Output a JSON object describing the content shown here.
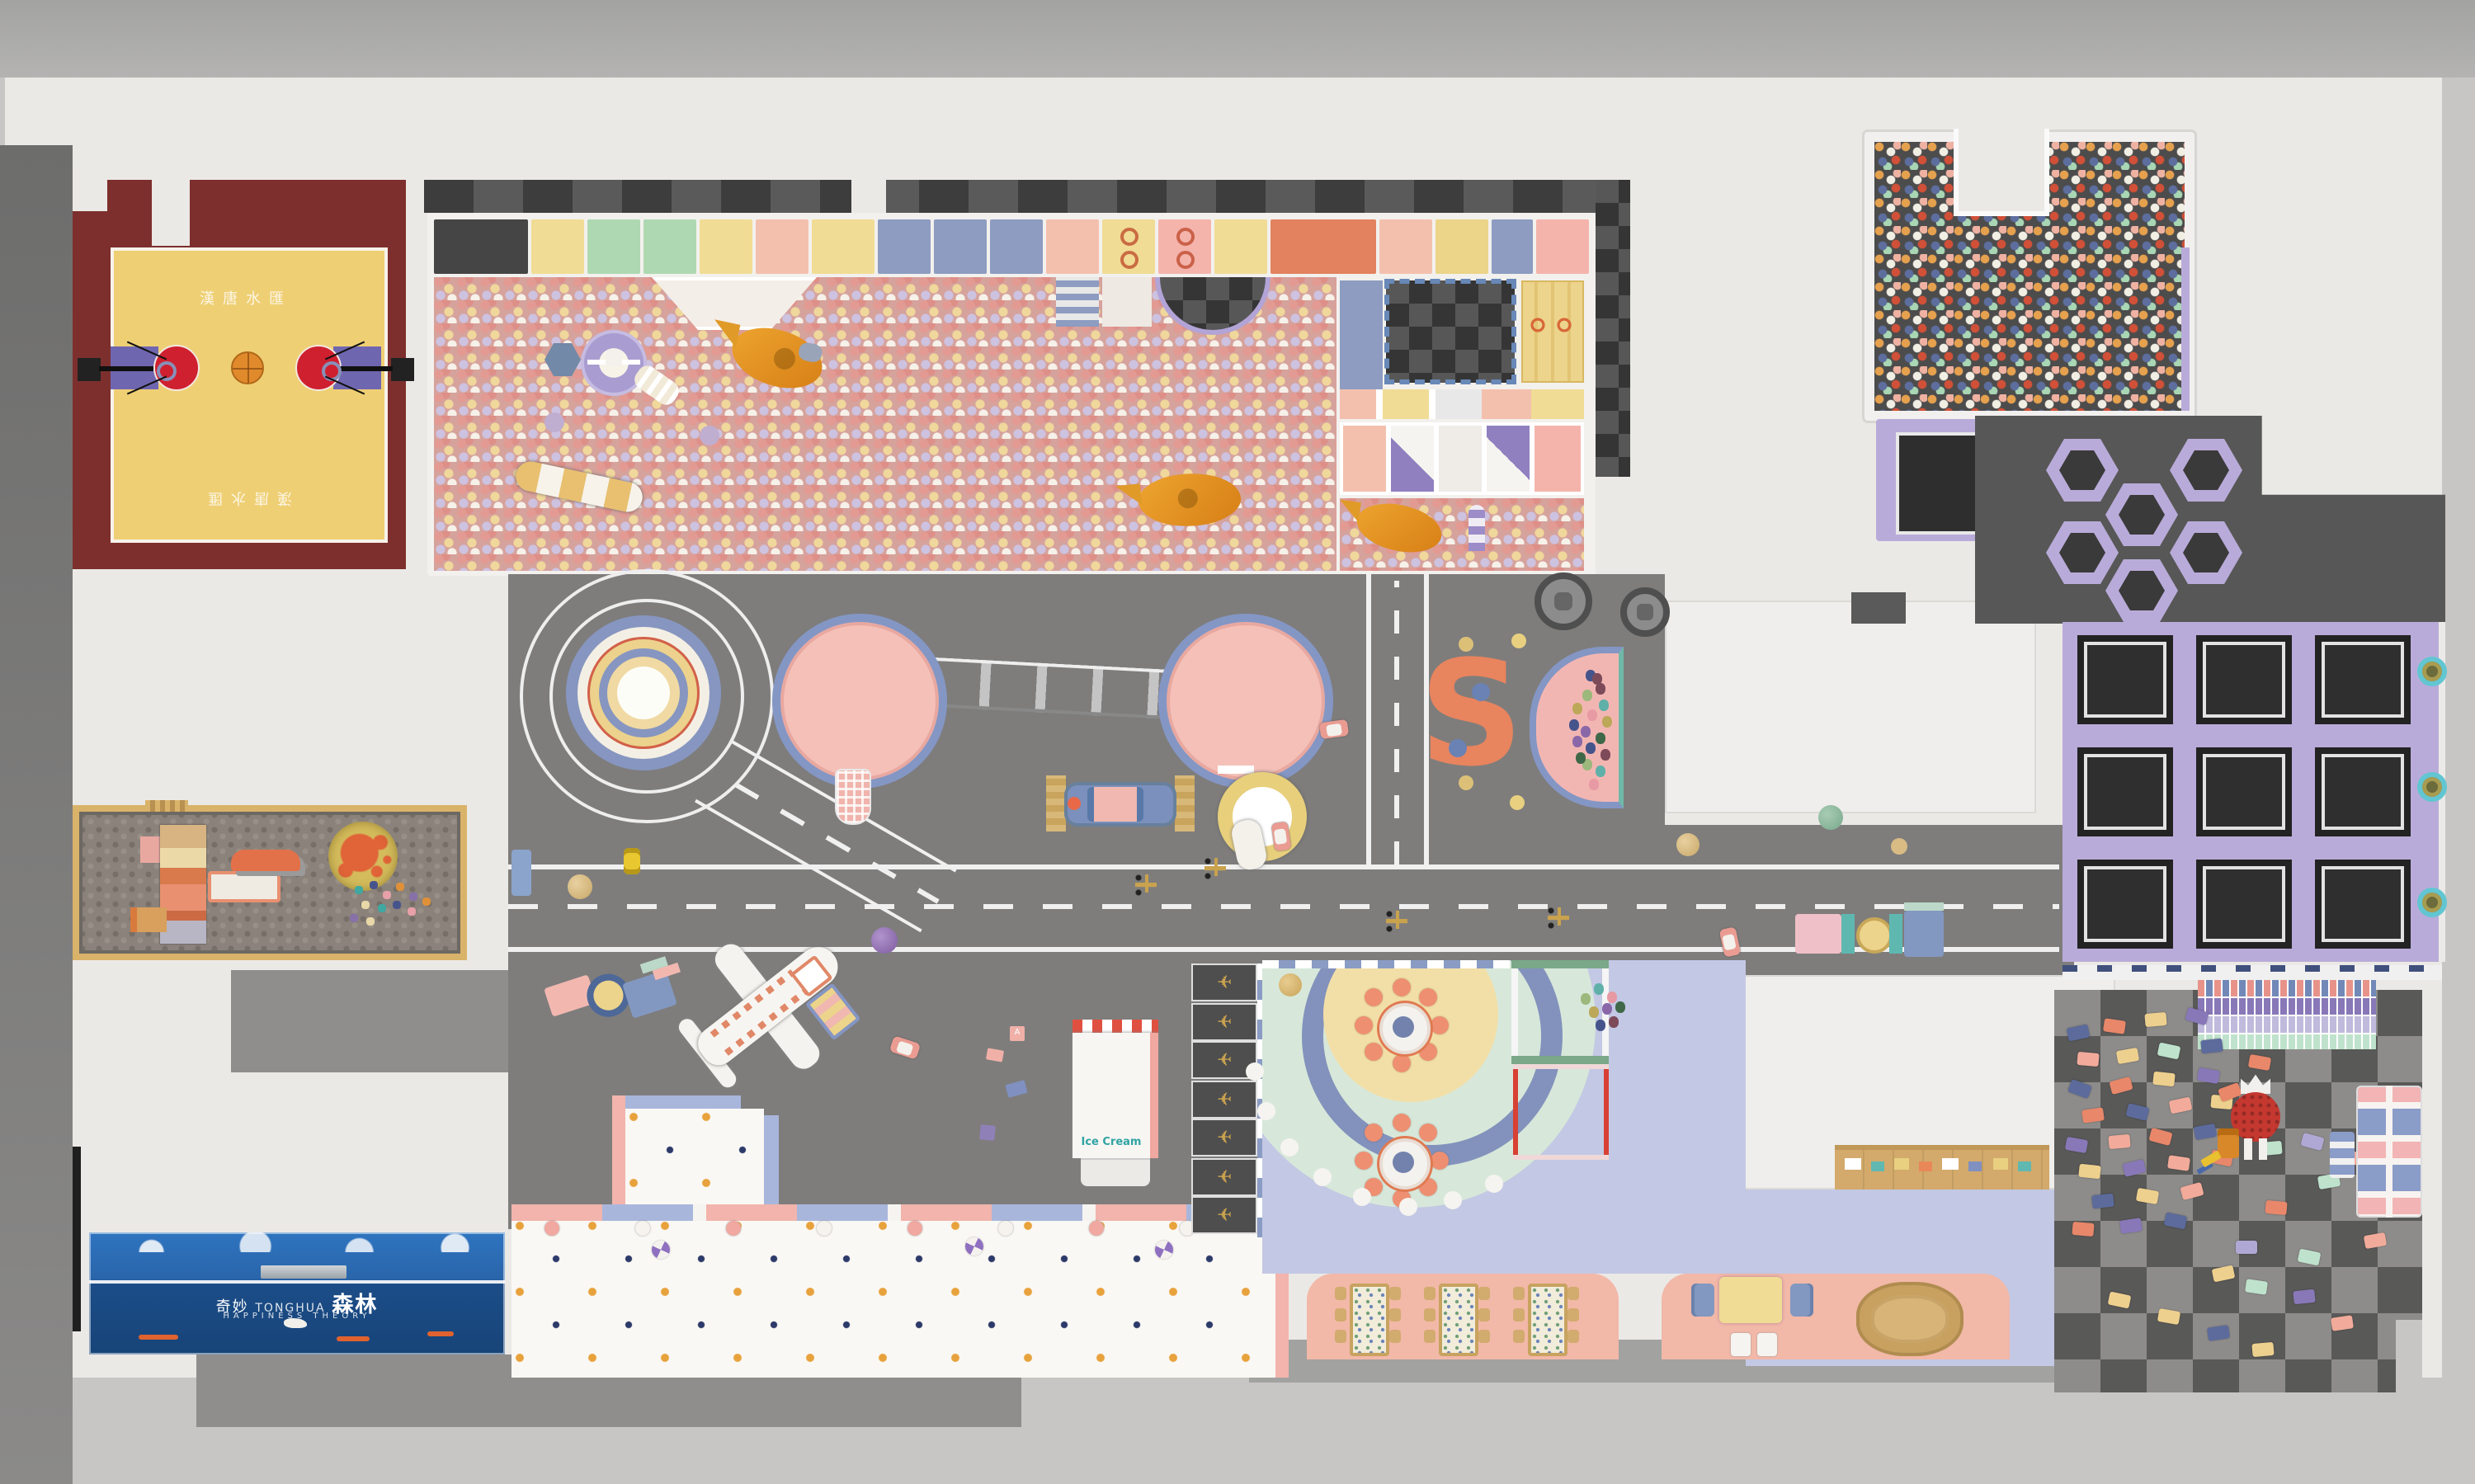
{
  "scene": {
    "kind": "indoor kids playground floor-plan render"
  },
  "text": {
    "court_name": "漢唐水匯",
    "ice_cream": "Ice Cream",
    "mural_prefix": "奇妙",
    "mural_en": "TONGHUA",
    "mural_main": "森林",
    "mural_sub": "HAPPINESS THEORY",
    "s_sculpture": "S",
    "toy_block_letter": "A",
    "spring_rider_glyph": "✈"
  },
  "colors": {
    "wall": "#ebe9e6",
    "floor_gray": "#7e7d7c",
    "court_maroon": "#7d2f2d",
    "court_yellow": "#efcf74",
    "key_purple": "#6f66b0",
    "circle_red": "#cf2030",
    "basketball_orange": "#e08a2c",
    "tramp_purple": "#b9abd9",
    "pink_platform": "#f4c0b8",
    "platform_rim": "#8496c4",
    "party_mint": "#d7e8da",
    "party_yellow": "#f2dfa8",
    "party_blue_ring": "#8392bc",
    "lavender_floor": "#c3c8e4",
    "counter_pink": "#f2b8a8",
    "stool_coral": "#ee8f72",
    "mural_blue": "#2a65aa",
    "ice_cream_teal": "#2fa3a3"
  },
  "ballpit": {
    "panels": [
      {
        "c": "#454545",
        "t": "mesh",
        "w": 9
      },
      {
        "c": "#f0dc94",
        "w": 5
      },
      {
        "c": "#aed8b2",
        "t": "mesh",
        "w": 5
      },
      {
        "c": "#aed8b2",
        "t": "mesh",
        "w": 5
      },
      {
        "c": "#f0dc94",
        "w": 5
      },
      {
        "c": "#f4c0ae",
        "w": 5
      },
      {
        "c": "#f0dc94",
        "w": 6
      },
      {
        "c": "#8d9cc0",
        "w": 5
      },
      {
        "c": "#8d9cc0",
        "w": 5
      },
      {
        "c": "#8d9cc0",
        "w": 5
      },
      {
        "c": "#f4c0ae",
        "w": 5
      },
      {
        "c": "#f0dc94",
        "t": "rings",
        "w": 5
      },
      {
        "c": "#f4b4ac",
        "t": "rings",
        "w": 5
      },
      {
        "c": "#f0dc94",
        "w": 5
      },
      {
        "c": "#e2825e",
        "t": "grid",
        "w": 10
      },
      {
        "c": "#f4c0ae",
        "w": 5
      },
      {
        "c": "#ecd488",
        "t": "tri",
        "w": 5
      },
      {
        "c": "#8d9cc0",
        "t": "tri2",
        "w": 4
      },
      {
        "c": "#f4b4ac",
        "w": 5
      }
    ]
  },
  "trampolines": {
    "grid_rows": 3,
    "grid_cols": 3,
    "hex_positions": [
      [
        1240,
        266
      ],
      [
        1315,
        266
      ],
      [
        1276,
        293
      ],
      [
        1240,
        316
      ],
      [
        1315,
        316
      ],
      [
        1276,
        339
      ]
    ],
    "ring_ys": [
      398,
      468,
      538
    ]
  },
  "spring_riders": {
    "count": 7
  },
  "party": {
    "tables": [
      [
        836,
        608
      ],
      [
        836,
        690
      ]
    ],
    "stools_per_table": 8,
    "balloon_cluster": [
      [
        958,
        602
      ],
      [
        966,
        596
      ],
      [
        974,
        601
      ],
      [
        963,
        610
      ],
      [
        971,
        608
      ],
      [
        979,
        607
      ],
      [
        967,
        618
      ],
      [
        975,
        616
      ]
    ],
    "dot_arc": [
      [
        900,
        712
      ],
      [
        875,
        722
      ],
      [
        848,
        726
      ],
      [
        820,
        720
      ],
      [
        796,
        708
      ],
      [
        776,
        690
      ],
      [
        762,
        668
      ],
      [
        755,
        644
      ]
    ]
  },
  "balloon_pool": {
    "colors": [
      "#46548c",
      "#7c4a58",
      "#9cb87c",
      "#5fb0a8",
      "#e89aa4",
      "#bca858",
      "#8a68a8",
      "#3f6848"
    ],
    "points": [
      [
        30,
        10
      ],
      [
        36,
        18
      ],
      [
        28,
        22
      ],
      [
        38,
        28
      ],
      [
        31,
        34
      ],
      [
        40,
        38
      ],
      [
        27,
        44
      ],
      [
        36,
        48
      ],
      [
        30,
        54
      ],
      [
        39,
        58
      ],
      [
        28,
        64
      ],
      [
        36,
        68
      ],
      [
        32,
        76
      ],
      [
        22,
        30
      ],
      [
        22,
        50
      ],
      [
        24,
        60
      ],
      [
        20,
        40
      ],
      [
        34,
        12
      ]
    ]
  },
  "legos": {
    "palette": [
      "#5c6b9c",
      "#e8876a",
      "#eed08e",
      "#8878b8",
      "#f2ab9a",
      "#bfe2cc",
      "#b0a8d4"
    ],
    "bricks": [
      [
        8,
        22,
        -12,
        0
      ],
      [
        30,
        18,
        8,
        1
      ],
      [
        55,
        14,
        -5,
        2
      ],
      [
        80,
        12,
        15,
        3
      ],
      [
        14,
        38,
        5,
        4
      ],
      [
        38,
        36,
        -10,
        2
      ],
      [
        63,
        33,
        12,
        5
      ],
      [
        89,
        30,
        -6,
        0
      ],
      [
        9,
        56,
        20,
        0
      ],
      [
        34,
        54,
        -15,
        1
      ],
      [
        60,
        50,
        6,
        2
      ],
      [
        87,
        48,
        10,
        3
      ],
      [
        17,
        72,
        -8,
        1
      ],
      [
        44,
        70,
        14,
        0
      ],
      [
        70,
        66,
        -12,
        4
      ],
      [
        95,
        64,
        5,
        2
      ],
      [
        7,
        90,
        10,
        3
      ],
      [
        33,
        88,
        -5,
        4
      ],
      [
        58,
        85,
        15,
        1
      ],
      [
        85,
        82,
        -10,
        0
      ],
      [
        15,
        106,
        6,
        2
      ],
      [
        42,
        104,
        -14,
        3
      ],
      [
        69,
        101,
        8,
        4
      ],
      [
        95,
        98,
        12,
        1
      ],
      [
        23,
        124,
        -6,
        0
      ],
      [
        50,
        121,
        10,
        2
      ],
      [
        77,
        118,
        -15,
        4
      ],
      [
        11,
        141,
        5,
        1
      ],
      [
        40,
        139,
        -8,
        3
      ],
      [
        67,
        136,
        12,
        0
      ],
      [
        100,
        58,
        -20,
        1
      ],
      [
        118,
        40,
        10,
        1
      ],
      [
        125,
        92,
        -5,
        5
      ],
      [
        150,
        88,
        15,
        6
      ],
      [
        160,
        112,
        -10,
        5
      ],
      [
        128,
        128,
        5,
        1
      ],
      [
        96,
        168,
        -12,
        2
      ],
      [
        116,
        176,
        8,
        5
      ],
      [
        145,
        182,
        -6,
        3
      ],
      [
        63,
        194,
        10,
        2
      ],
      [
        93,
        204,
        -8,
        0
      ],
      [
        33,
        184,
        12,
        2
      ],
      [
        120,
        214,
        -5,
        2
      ],
      [
        175,
        98,
        5,
        4
      ],
      [
        188,
        148,
        -10,
        4
      ],
      [
        205,
        118,
        8,
        4
      ],
      [
        148,
        158,
        12,
        5
      ],
      [
        168,
        198,
        -8,
        4
      ],
      [
        110,
        152,
        0,
        6
      ]
    ]
  },
  "counter1": {
    "tables_x": [
      26,
      80,
      134
    ],
    "chair_rows": [
      8,
      21,
      34
    ]
  },
  "toddler": {
    "candy_xs": [
      330,
      385,
      440,
      495,
      550,
      605,
      660,
      715
    ],
    "swirls": [
      [
        395,
        752
      ],
      [
        585,
        750
      ],
      [
        700,
        752
      ]
    ]
  },
  "sand_toys": [
    [
      5,
      5,
      "#3fa8a0"
    ],
    [
      14,
      2,
      "#46548c"
    ],
    [
      22,
      8,
      "#e8a0a8"
    ],
    [
      30,
      3,
      "#e09038"
    ],
    [
      38,
      9,
      "#8870a8"
    ],
    [
      9,
      14,
      "#e8d8a8"
    ],
    [
      19,
      16,
      "#3fa8a0"
    ],
    [
      28,
      14,
      "#46548c"
    ],
    [
      37,
      18,
      "#e8a0a8"
    ],
    [
      46,
      12,
      "#e09038"
    ],
    [
      2,
      22,
      "#8870a8"
    ],
    [
      12,
      24,
      "#e8d8a8"
    ]
  ]
}
